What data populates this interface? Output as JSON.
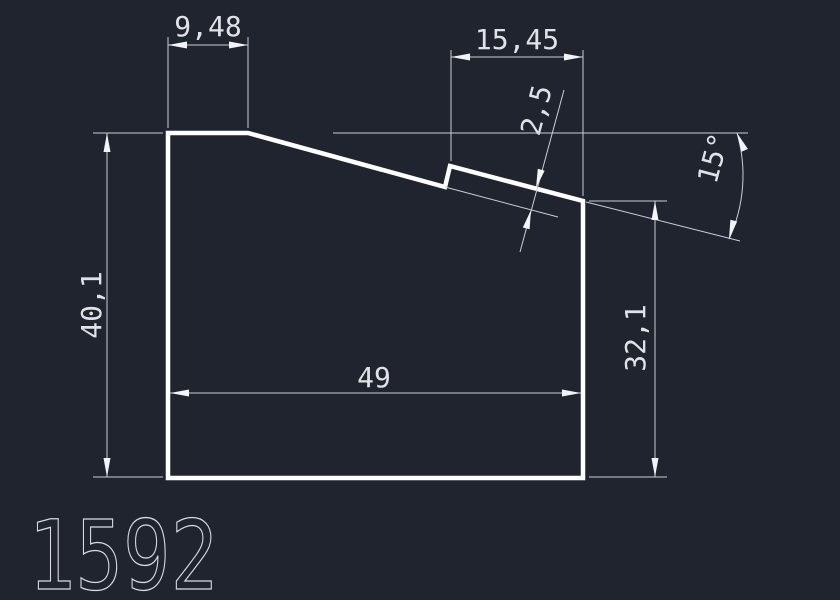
{
  "drawing": {
    "part_number": "1592",
    "dimensions": {
      "top_width": "9,48",
      "upper_width": "15,45",
      "step_offset": "2,5",
      "angle": "15°",
      "left_height": "40,1",
      "right_height": "32,1",
      "bottom_width": "49"
    },
    "colors": {
      "background": "#20242e",
      "outline": "#ffffff",
      "dimension_lines": "#c9ced6",
      "text": "#dfe3e7"
    }
  }
}
